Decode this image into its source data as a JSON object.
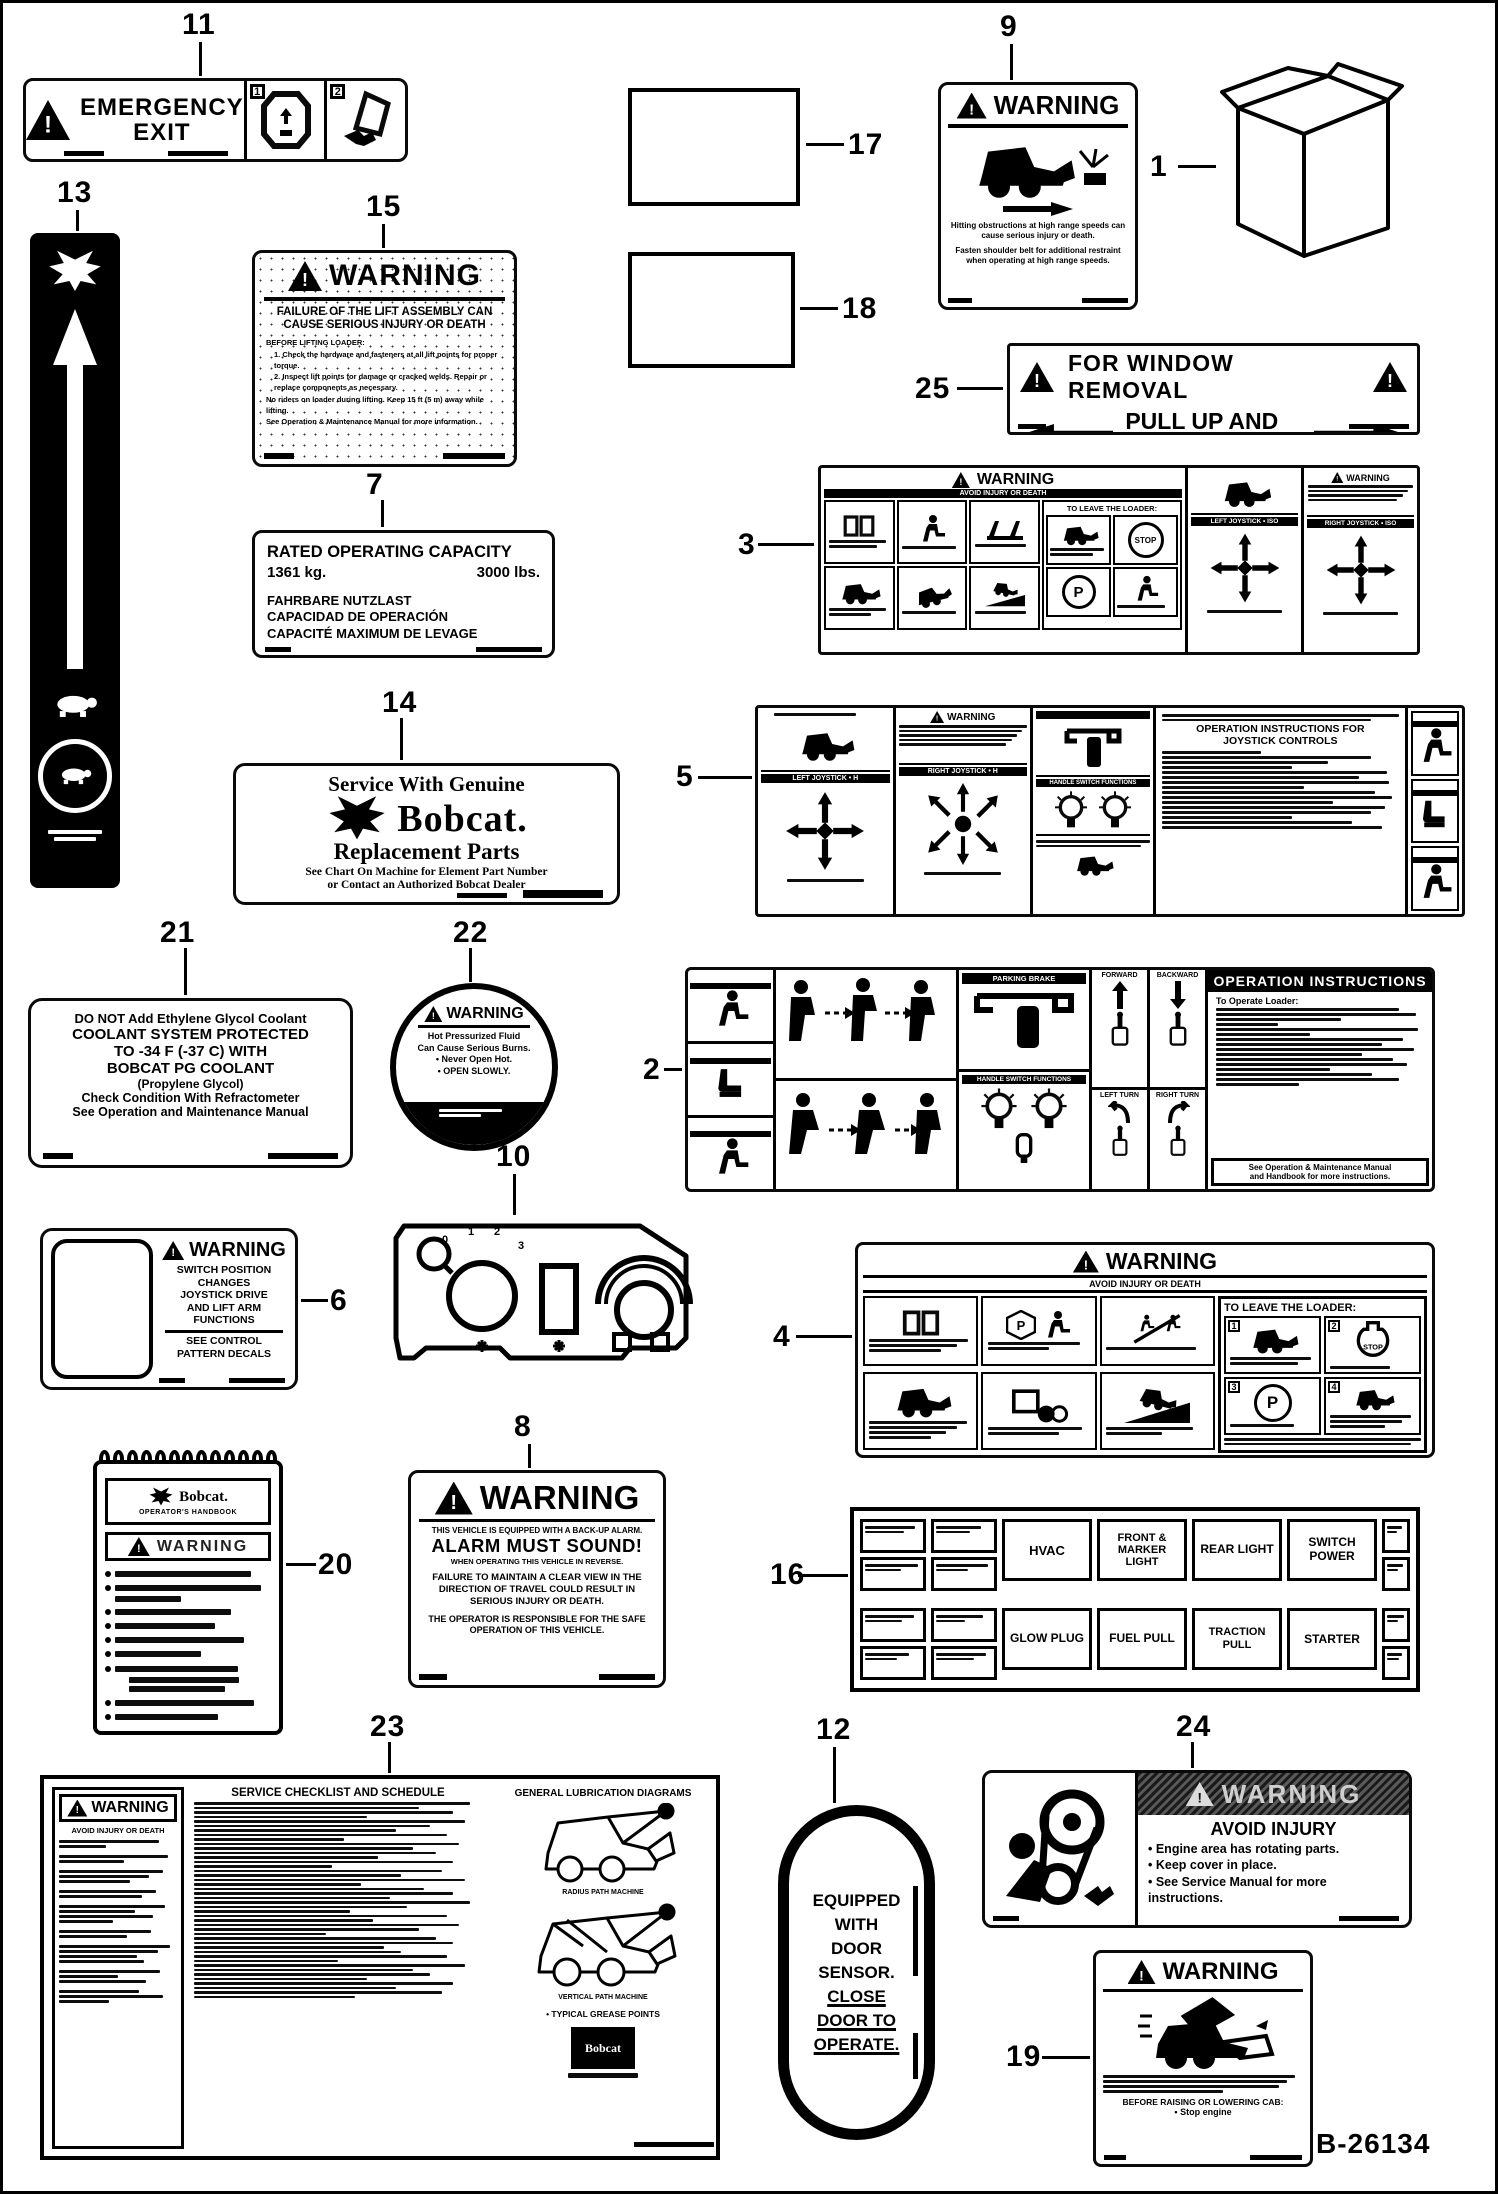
{
  "page": {
    "code": "B-26134"
  },
  "callouts": {
    "1": "1",
    "2": "2",
    "3": "3",
    "4": "4",
    "5": "5",
    "6": "6",
    "7": "7",
    "8": "8",
    "9": "9",
    "10": "10",
    "11": "11",
    "12": "12",
    "13": "13",
    "14": "14",
    "15": "15",
    "16": "16",
    "17": "17",
    "18": "18",
    "19": "19",
    "20": "20",
    "21": "21",
    "22": "22",
    "23": "23",
    "24": "24",
    "25": "25"
  },
  "decals": {
    "emergency_exit": {
      "line1": "EMERGENCY",
      "line2": "EXIT",
      "step1": "1",
      "step2": "2"
    },
    "lift": {
      "warning": "WARNING",
      "title1": "FAILURE OF THE LIFT ASSEMBLY CAN",
      "title2": "CAUSE SERIOUS INJURY OR DEATH",
      "b1": "BEFORE LIFTING LOADER:",
      "b2": "1. Check the hardware and fasteners at all lift points for proper torque.",
      "b3": "2. Inspect lift points for damage or cracked welds. Repair or replace components as necessary.",
      "b4": "No riders on loader during lifting. Keep 15 ft (5 m) away while lifting.",
      "b5": "See Operation & Maintenance Manual for more information."
    },
    "capacity": {
      "title": "RATED OPERATING CAPACITY",
      "kg": "1361 kg.",
      "lbs": "3000 lbs.",
      "de": "FAHRBARE NUTZLAST",
      "es": "CAPACIDAD DE OPERACIÓN",
      "fr": "CAPACITÉ MAXIMUM DE LEVAGE"
    },
    "genuine_parts": {
      "l1": "Service With Genuine",
      "brand": "Bobcat.",
      "l2": "Replacement Parts",
      "l3": "See Chart On Machine for Element Part Number",
      "l4": "or Contact an Authorized Bobcat Dealer"
    },
    "high_speed": {
      "warning": "WARNING",
      "p1": "Hitting obstructions at high range speeds can cause serious injury or death.",
      "p2": "Fasten shoulder belt for additional restraint when operating at high range speeds."
    },
    "window_removal": {
      "l1": "FOR WINDOW REMOVAL",
      "l2": "PULL UP AND OUT"
    },
    "decal3": {
      "warning": "WARNING",
      "sub": "AVOID INJURY OR DEATH",
      "leave": "TO LEAVE THE LOADER:",
      "stop": "STOP",
      "p": "P",
      "left_h": "LEFT JOYSTICK • ISO",
      "right_h": "RIGHT JOYSTICK • ISO"
    },
    "decal5": {
      "left_h": "LEFT JOYSTICK • H",
      "right_h": "RIGHT JOYSTICK • H",
      "warning": "WARNING",
      "hand": "HANDLE SWITCH FUNCTIONS",
      "title1": "OPERATION INSTRUCTIONS FOR",
      "title2": "JOYSTICK CONTROLS"
    },
    "decal2": {
      "ops_title": "OPERATION INSTRUCTIONS",
      "to_operate": "To Operate Loader:",
      "parking": "PARKING BRAKE",
      "handle": "HANDLE SWITCH FUNCTIONS",
      "fwd": "FORWARD",
      "bwd": "BACKWARD",
      "left_turn": "LEFT TURN",
      "right_turn": "RIGHT TURN",
      "see1": "See Operation & Maintenance Manual",
      "see2": "and Handbook for more instructions."
    },
    "decal4": {
      "warning": "WARNING",
      "sub": "AVOID INJURY OR DEATH",
      "leave": "TO LEAVE THE LOADER:",
      "stop": "STOP",
      "p": "P",
      "n1": "1",
      "n2": "2",
      "n3": "3",
      "n4": "4"
    },
    "coolant": {
      "l1": "DO NOT Add Ethylene Glycol Coolant",
      "l2": "COOLANT SYSTEM PROTECTED",
      "l3": "TO -34 F (-37 C) WITH",
      "l4": "BOBCAT PG COOLANT",
      "l5": "(Propylene Glycol)",
      "l6": "Check Condition With Refractometer",
      "l7": "See Operation and Maintenance Manual"
    },
    "radiator": {
      "warning": "WARNING",
      "l1": "Hot Pressurized Fluid",
      "l2": "Can Cause Serious Burns.",
      "l3": "• Never Open Hot.",
      "l4": "• OPEN SLOWLY."
    },
    "switch_pos": {
      "warning": "WARNING",
      "l1": "SWITCH POSITION",
      "l2": "CHANGES",
      "l3": "JOYSTICK DRIVE",
      "l4": "AND LIFT ARM",
      "l5": "FUNCTIONS",
      "l6": "SEE CONTROL",
      "l7": "PATTERN DECALS"
    },
    "panel10": {
      "k0": "0",
      "k1": "1",
      "k2": "2",
      "k3": "3"
    },
    "handbook": {
      "brand": "Bobcat.",
      "subtitle": "OPERATOR'S HANDBOOK",
      "warning": "WARNING"
    },
    "backup": {
      "warning": "WARNING",
      "l1": "THIS VEHICLE IS EQUIPPED WITH A BACK-UP ALARM.",
      "big": "ALARM MUST SOUND!",
      "l2": "WHEN OPERATING THIS VEHICLE IN REVERSE.",
      "p1": "FAILURE TO MAINTAIN A CLEAR VIEW IN THE DIRECTION OF TRAVEL COULD RESULT IN SERIOUS INJURY OR DEATH.",
      "p2": "THE OPERATOR IS RESPONSIBLE FOR THE SAFE OPERATION OF THIS VEHICLE."
    },
    "fuse": {
      "b1": "HVAC",
      "b2": "FRONT & MARKER LIGHT",
      "b3": "REAR LIGHT",
      "b4": "SWITCH POWER",
      "b5": "GLOW PLUG",
      "b6": "FUEL PULL",
      "b7": "TRACTION PULL",
      "b8": "STARTER"
    },
    "checklist": {
      "warning": "WARNING",
      "sub": "AVOID INJURY OR DEATH",
      "title": "SERVICE CHECKLIST AND SCHEDULE",
      "lube_title": "GENERAL LUBRICATION DIAGRAMS",
      "cap1": "RADIUS PATH MACHINE",
      "cap2": "VERTICAL PATH MACHINE",
      "grease": "• TYPICAL GREASE POINTS",
      "brand": "Bobcat"
    },
    "door": {
      "l1": "EQUIPPED",
      "l2": "WITH",
      "l3": "DOOR",
      "l4": "SENSOR.",
      "l5": "CLOSE",
      "l6": "DOOR TO",
      "l7": "OPERATE."
    },
    "engine": {
      "warning": "WARNING",
      "title": "AVOID INJURY",
      "b1": "• Engine area has rotating parts.",
      "b2": "• Keep cover in place.",
      "b3": "• See Service Manual for more instructions."
    },
    "cab": {
      "warning": "WARNING",
      "before": "BEFORE RAISING OR LOWERING CAB:",
      "stop": "• Stop engine"
    }
  }
}
